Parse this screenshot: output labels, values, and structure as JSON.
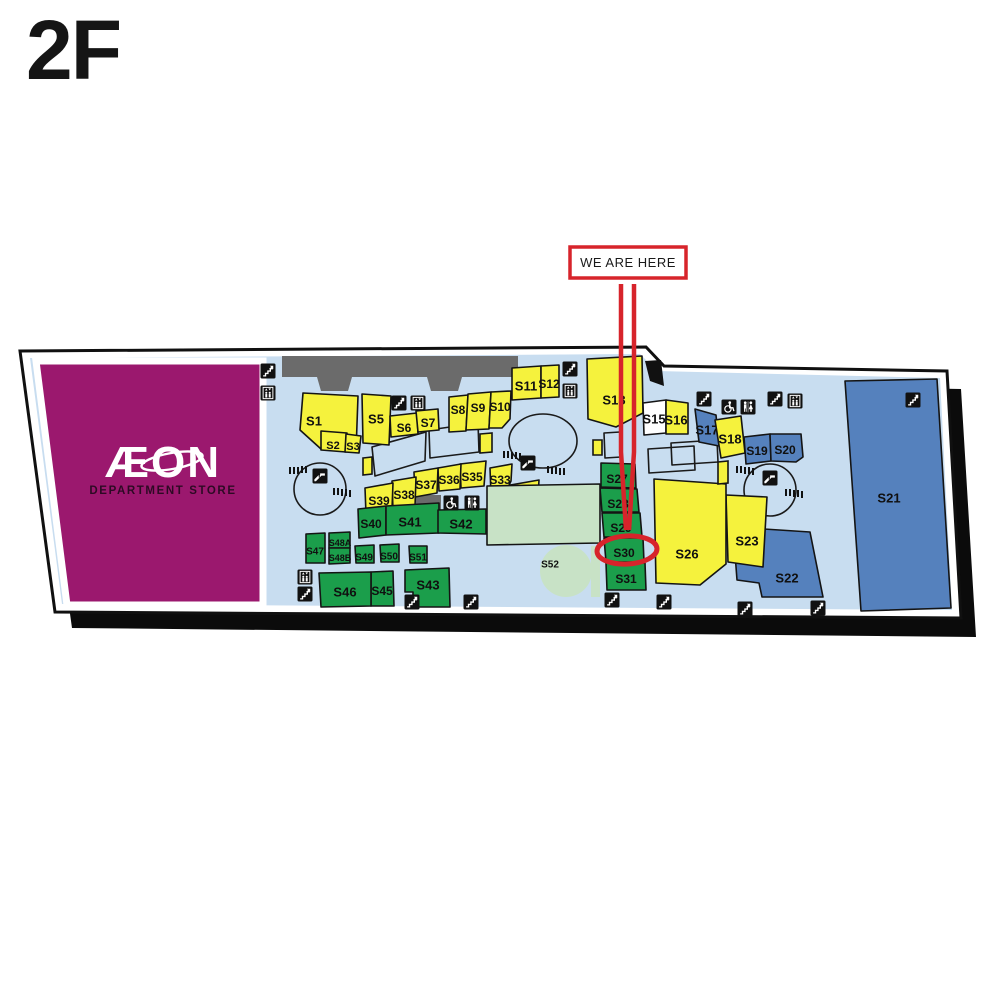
{
  "title": "2F",
  "aeon": {
    "name": "ÆON",
    "subtitle": "DEPARTMENT STORE"
  },
  "annotation": {
    "we_are_here": "WE ARE HERE",
    "highlighted_shop": "S30"
  },
  "colors": {
    "yellow": "#f5f23d",
    "green": "#1b9e4b",
    "blue": "#5581bd",
    "white_shop": "#ffffff",
    "pale_green": "#c8e2c6",
    "magenta": "#9b186e",
    "light_blue": "#c8ddf0",
    "corridor_gray": "#6b6b6b",
    "red": "#d7242b"
  },
  "shops": [
    {
      "id": "S1",
      "label": "S1",
      "color": "yellow",
      "poly": "303,393 358,396 356,452 321,449 300,430",
      "lx": 314,
      "ly": 421,
      "fs": 13
    },
    {
      "id": "S2",
      "label": "S2",
      "color": "yellow",
      "poly": "321,431 347,433 346,452 321,450",
      "lx": 333,
      "ly": 445,
      "fs": 11
    },
    {
      "id": "S3",
      "label": "S3",
      "color": "yellow",
      "poly": "346,434 361,436 359,453 345,452",
      "lx": 353,
      "ly": 446,
      "fs": 11
    },
    {
      "id": "S5",
      "label": "S5",
      "color": "yellow",
      "poly": "362,394 391,396 389,445 363,443",
      "lx": 376,
      "ly": 419,
      "fs": 13
    },
    {
      "id": "S6",
      "label": "S6",
      "color": "yellow",
      "poly": "390,416 417,413 418,434 391,437",
      "lx": 404,
      "ly": 428,
      "fs": 12
    },
    {
      "id": "S7",
      "label": "S7",
      "color": "yellow",
      "poly": "416,411 438,409 439,430 418,432",
      "lx": 428,
      "ly": 423,
      "fs": 12
    },
    {
      "id": "S8",
      "label": "S8",
      "color": "yellow",
      "poly": "449,397 468,395 466,431 449,432",
      "lx": 458,
      "ly": 410,
      "fs": 12
    },
    {
      "id": "S9",
      "label": "S9",
      "color": "yellow",
      "poly": "468,394 491,392 489,429 466,430",
      "lx": 478,
      "ly": 408,
      "fs": 12
    },
    {
      "id": "S10",
      "label": "S10",
      "color": "yellow",
      "poly": "491,392 511,391 510,419 502,428 489,428",
      "lx": 500,
      "ly": 407,
      "fs": 12
    },
    {
      "id": "S11",
      "label": "S11",
      "color": "yellow",
      "poly": "512,368 541,366 541,398 512,400",
      "lx": 526,
      "ly": 386,
      "fs": 13
    },
    {
      "id": "S12",
      "label": "S12",
      "color": "yellow",
      "poly": "541,366 559,365 559,397 541,398",
      "lx": 549,
      "ly": 384,
      "fs": 12
    },
    {
      "id": "S13",
      "label": "S13",
      "color": "yellow",
      "poly": "587,359 642,356 643,413 616,427 588,419",
      "lx": 614,
      "ly": 400,
      "fs": 13
    },
    {
      "id": "S15",
      "label": "S15",
      "color": "white_shop",
      "poly": "643,403 666,400 666,433 644,435",
      "lx": 654,
      "ly": 419,
      "fs": 13
    },
    {
      "id": "S16",
      "label": "S16",
      "color": "yellow",
      "poly": "666,400 688,403 688,434 666,434",
      "lx": 676,
      "ly": 420,
      "fs": 13
    },
    {
      "id": "S17",
      "label": "S17",
      "color": "blue",
      "poly": "695,409 716,415 719,446 699,442",
      "lx": 707,
      "ly": 430,
      "fs": 13
    },
    {
      "id": "S18",
      "label": "S18",
      "color": "yellow",
      "poly": "715,420 741,416 745,453 721,458",
      "lx": 730,
      "ly": 439,
      "fs": 13
    },
    {
      "id": "S19",
      "label": "S19",
      "color": "blue",
      "poly": "744,437 770,434 771,461 746,464",
      "lx": 757,
      "ly": 451,
      "fs": 12
    },
    {
      "id": "S20",
      "label": "S20",
      "color": "blue",
      "poly": "770,434 801,434 803,457 796,462 771,461",
      "lx": 785,
      "ly": 450,
      "fs": 12
    },
    {
      "id": "S21",
      "label": "S21",
      "color": "blue",
      "poly": "845,381 937,379 951,608 861,611",
      "lx": 889,
      "ly": 498,
      "fs": 13
    },
    {
      "id": "S22",
      "label": "S22",
      "color": "blue",
      "poly": "733,527 810,532 823,597 762,597 759,583 737,580",
      "lx": 787,
      "ly": 578,
      "fs": 13
    },
    {
      "id": "S23",
      "label": "S23",
      "color": "yellow",
      "poly": "726,495 767,497 763,567 728,562",
      "lx": 747,
      "ly": 541,
      "fs": 13
    },
    {
      "id": "S25",
      "label": "S25",
      "color": "yellow",
      "poly": "695,501 721,500 721,541 699,541",
      "lx": 708,
      "ly": 521,
      "fs": 12
    },
    {
      "id": "S26",
      "label": "S26",
      "color": "yellow",
      "poly": "654,479 726,484 726,564 700,585 656,583",
      "lx": 687,
      "ly": 554,
      "fs": 13
    },
    {
      "id": "S27",
      "label": "S27",
      "color": "green",
      "poly": "601,463 635,464 636,488 601,487",
      "lx": 617,
      "ly": 479,
      "fs": 12
    },
    {
      "id": "S28",
      "label": "S28",
      "color": "green",
      "poly": "600,488 637,489 639,512 602,512",
      "lx": 618,
      "ly": 504,
      "fs": 12
    },
    {
      "id": "S29",
      "label": "S29",
      "color": "green",
      "poly": "602,513 640,513 642,537 604,537",
      "lx": 621,
      "ly": 528,
      "fs": 12
    },
    {
      "id": "S30",
      "label": "S30",
      "color": "green",
      "poly": "604,538 643,538 644,562 606,562",
      "lx": 624,
      "ly": 553,
      "fs": 12
    },
    {
      "id": "S31",
      "label": "S31",
      "color": "green",
      "poly": "606,563 645,563 646,590 607,590",
      "lx": 626,
      "ly": 579,
      "fs": 12
    },
    {
      "id": "S32",
      "label": "S32",
      "color": "yellow",
      "poly": "505,486 539,480 538,497 506,498",
      "lx": 522,
      "ly": 493,
      "fs": 12
    },
    {
      "id": "S33",
      "label": "S33",
      "color": "yellow",
      "poly": "490,468 512,464 511,481 504,496 491,495",
      "lx": 500,
      "ly": 480,
      "fs": 12
    },
    {
      "id": "S35",
      "label": "S35",
      "color": "yellow",
      "poly": "460,464 486,461 484,486 461,488",
      "lx": 472,
      "ly": 477,
      "fs": 12
    },
    {
      "id": "S36",
      "label": "S36",
      "color": "yellow",
      "poly": "438,468 461,464 460,489 439,491",
      "lx": 449,
      "ly": 480,
      "fs": 12
    },
    {
      "id": "S37",
      "label": "S37",
      "color": "yellow",
      "poly": "414,472 438,468 437,493 415,497",
      "lx": 426,
      "ly": 485,
      "fs": 12
    },
    {
      "id": "S38",
      "label": "S38",
      "color": "yellow",
      "poly": "392,481 416,477 415,507 393,510",
      "lx": 404,
      "ly": 495,
      "fs": 12
    },
    {
      "id": "S39",
      "label": "S39",
      "color": "yellow",
      "poly": "365,488 393,483 392,509 366,514",
      "lx": 379,
      "ly": 501,
      "fs": 12
    },
    {
      "id": "S40",
      "label": "S40",
      "color": "green",
      "poly": "358,509 386,506 386,535 359,538",
      "lx": 371,
      "ly": 524,
      "fs": 12
    },
    {
      "id": "S41",
      "label": "S41",
      "color": "green",
      "poly": "386,506 439,503 439,533 386,535",
      "lx": 410,
      "ly": 522,
      "fs": 13
    },
    {
      "id": "S42",
      "label": "S42",
      "color": "green",
      "poly": "438,510 486,509 486,534 438,533",
      "lx": 461,
      "ly": 524,
      "fs": 13
    },
    {
      "id": "S43",
      "label": "S43",
      "color": "green",
      "poly": "405,570 449,568 450,607 413,607 413,592 405,592",
      "lx": 428,
      "ly": 585,
      "fs": 13
    },
    {
      "id": "S45",
      "label": "S45",
      "color": "green",
      "poly": "371,572 393,571 394,606 371,606",
      "lx": 382,
      "ly": 591,
      "fs": 12
    },
    {
      "id": "S46",
      "label": "S46",
      "color": "green",
      "poly": "319,573 371,572 371,606 321,607",
      "lx": 345,
      "ly": 592,
      "fs": 13
    },
    {
      "id": "S47",
      "label": "S47",
      "color": "green",
      "poly": "306,534 325,533 325,563 306,563",
      "lx": 315,
      "ly": 551,
      "fs": 10
    },
    {
      "id": "S48A",
      "label": "S48A",
      "color": "green",
      "poly": "329,533 350,532 350,548 329,548",
      "lx": 340,
      "ly": 543,
      "fs": 9
    },
    {
      "id": "S48B",
      "label": "S48B",
      "color": "green",
      "poly": "329,548 350,548 350,563 329,564",
      "lx": 340,
      "ly": 558,
      "fs": 9
    },
    {
      "id": "S49",
      "label": "S49",
      "color": "green",
      "poly": "355,546 374,545 374,563 356,563",
      "lx": 364,
      "ly": 557,
      "fs": 10
    },
    {
      "id": "S50",
      "label": "S50",
      "color": "green",
      "poly": "380,545 399,544 399,562 381,562",
      "lx": 389,
      "ly": 556,
      "fs": 10
    },
    {
      "id": "S51",
      "label": "S51",
      "color": "green",
      "poly": "409,546 427,546 427,563 410,563",
      "lx": 418,
      "ly": 557,
      "fs": 10
    },
    {
      "id": "S52",
      "label": "S52",
      "color": "pale_green",
      "poly": "487,486 600,484 600,543 487,545",
      "lx": 550,
      "ly": 564,
      "fs": 10
    }
  ],
  "icons": [
    {
      "type": "stairs",
      "x": 268,
      "y": 371
    },
    {
      "type": "elevator",
      "x": 268,
      "y": 393
    },
    {
      "type": "stairs",
      "x": 399,
      "y": 403
    },
    {
      "type": "elevator",
      "x": 418,
      "y": 403
    },
    {
      "type": "stairs",
      "x": 570,
      "y": 369
    },
    {
      "type": "elevator",
      "x": 570,
      "y": 391
    },
    {
      "type": "stairs",
      "x": 704,
      "y": 399
    },
    {
      "type": "wheelchair",
      "x": 729,
      "y": 407
    },
    {
      "type": "toilets",
      "x": 748,
      "y": 407
    },
    {
      "type": "stairs",
      "x": 775,
      "y": 399
    },
    {
      "type": "elevator",
      "x": 795,
      "y": 401
    },
    {
      "type": "stairs",
      "x": 913,
      "y": 400
    },
    {
      "type": "escalator",
      "x": 320,
      "y": 476
    },
    {
      "type": "escalator",
      "x": 528,
      "y": 463
    },
    {
      "type": "escalator",
      "x": 770,
      "y": 478
    },
    {
      "type": "wheelchair",
      "x": 451,
      "y": 503
    },
    {
      "type": "toilets",
      "x": 472,
      "y": 503
    },
    {
      "type": "elevator",
      "x": 305,
      "y": 577
    },
    {
      "type": "stairs",
      "x": 305,
      "y": 594
    },
    {
      "type": "stairs",
      "x": 412,
      "y": 602
    },
    {
      "type": "stairs",
      "x": 471,
      "y": 602
    },
    {
      "type": "stairs",
      "x": 612,
      "y": 600
    },
    {
      "type": "stairs",
      "x": 664,
      "y": 602
    },
    {
      "type": "stairs",
      "x": 745,
      "y": 609
    },
    {
      "type": "stairs",
      "x": 818,
      "y": 608
    }
  ]
}
